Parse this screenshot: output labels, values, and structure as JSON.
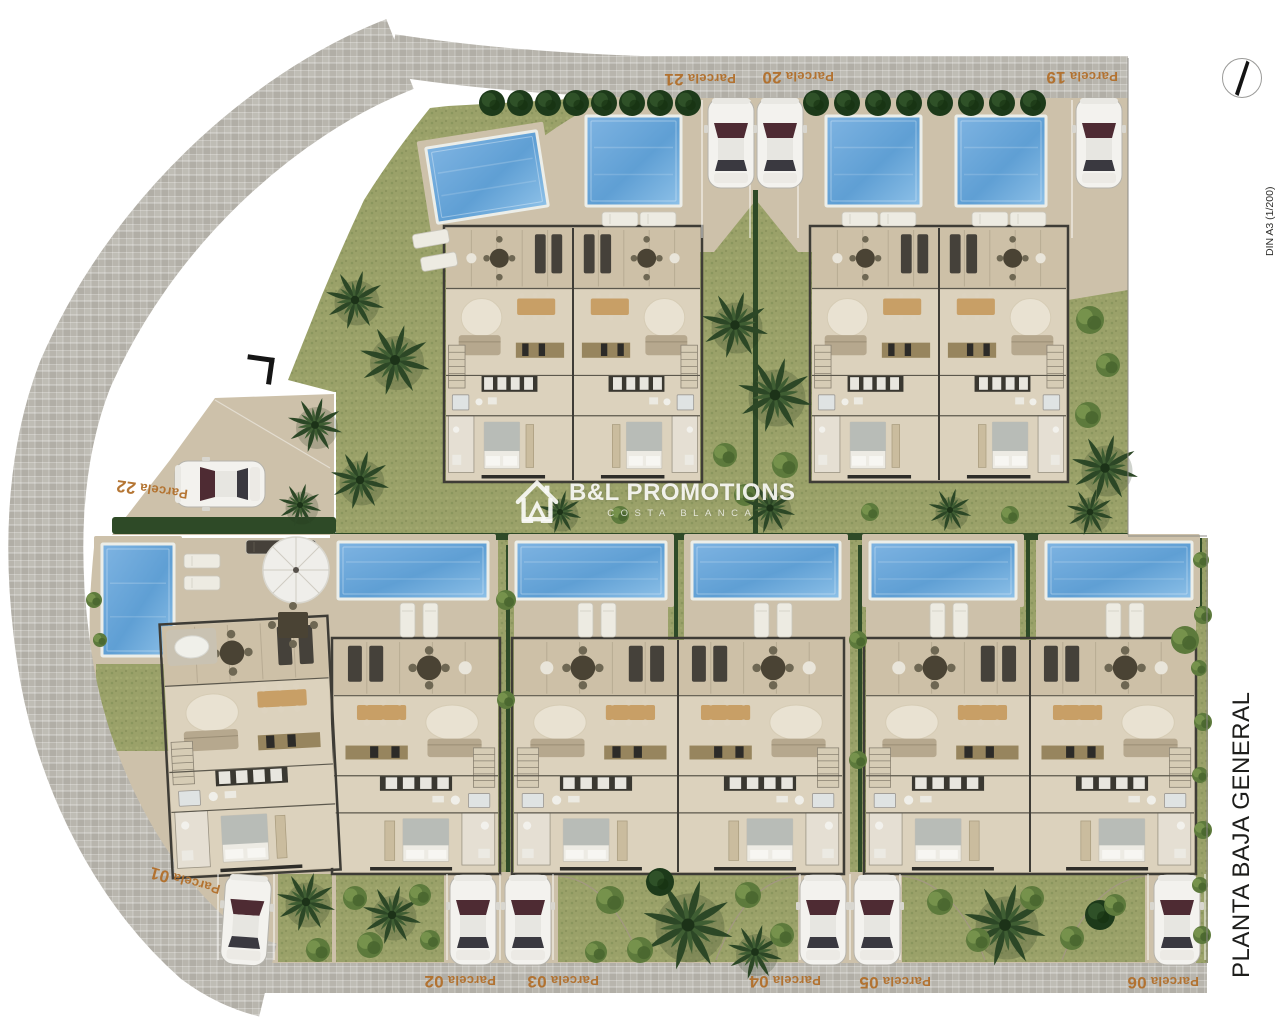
{
  "titles": {
    "sheet_title": "PLANTA BAJA GENERAL",
    "format_scale": "DIN A3 (1/200)"
  },
  "logo": {
    "name": "B&L PROMOTIONS",
    "subtitle": "COSTA BLANCA"
  },
  "parcels": [
    {
      "id": "01",
      "word": "Parcela",
      "num": "01"
    },
    {
      "id": "02",
      "word": "Parcela",
      "num": "02"
    },
    {
      "id": "03",
      "word": "Parcela",
      "num": "03"
    },
    {
      "id": "04",
      "word": "Parcela",
      "num": "04"
    },
    {
      "id": "05",
      "word": "Parcela",
      "num": "05"
    },
    {
      "id": "06",
      "word": "Parcela",
      "num": "06"
    },
    {
      "id": "19",
      "word": "Parcela",
      "num": "19"
    },
    {
      "id": "20",
      "word": "Parcela",
      "num": "20"
    },
    {
      "id": "21",
      "word": "Parcela",
      "num": "21"
    },
    {
      "id": "22",
      "word": "Parcela",
      "num": "22"
    }
  ],
  "colors": {
    "pavement": "#b8b5ad",
    "ground": "#cdc1aa",
    "floor": "#dcd2bd",
    "terrace": "#cdc0a7",
    "grass": "#9aa169",
    "grass_dark": "#7e8c55",
    "hedge": "#2e4a27",
    "pool": "#5f9fd4",
    "pool_light": "#9ccae9",
    "pool_rim": "#eceee9",
    "label": "#b26f2a",
    "wall": "#3e3c36",
    "car": "#f3f2ee",
    "text": "#1b1b1b",
    "logo": "#f4f4f0"
  }
}
